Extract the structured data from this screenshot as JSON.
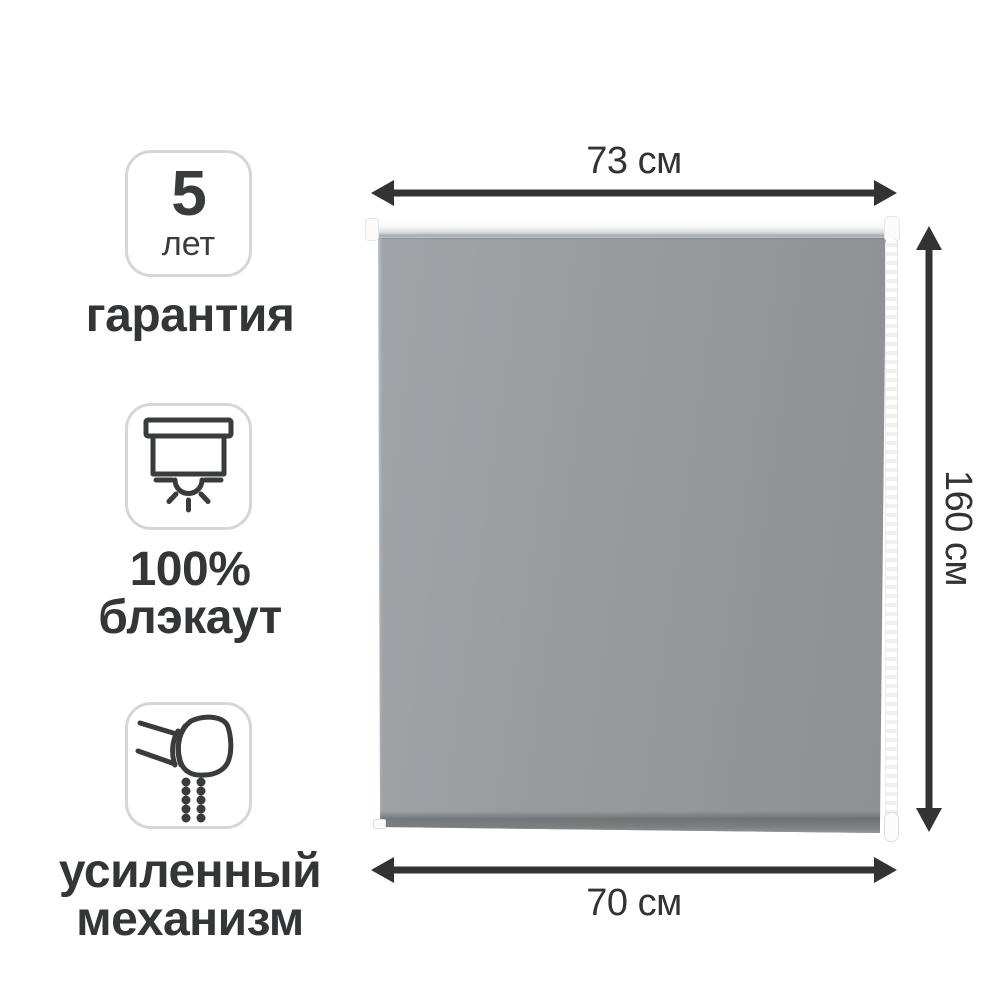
{
  "features": [
    {
      "name": "warranty",
      "badge_value": "5",
      "badge_unit": "лет",
      "label": "гарантия",
      "icon": "none"
    },
    {
      "name": "blackout",
      "label_line1": "100%",
      "label_line2": "блэкаут",
      "icon": "blackout-blind-sun-icon"
    },
    {
      "name": "mechanism",
      "label_line1": "усиленный",
      "label_line2": "механизм",
      "icon": "roller-mechanism-chain-icon"
    }
  ],
  "dimensions": {
    "top_width": "73 см",
    "height": "160 см",
    "bottom_width": "70 см"
  },
  "product": {
    "type": "roller-blind"
  },
  "colors": {
    "text": "#363738",
    "arrow": "#333333",
    "badge_border": "#d6d6d6",
    "fabric_gray": "#97999c",
    "cassette_white": "#f5f6f6"
  }
}
